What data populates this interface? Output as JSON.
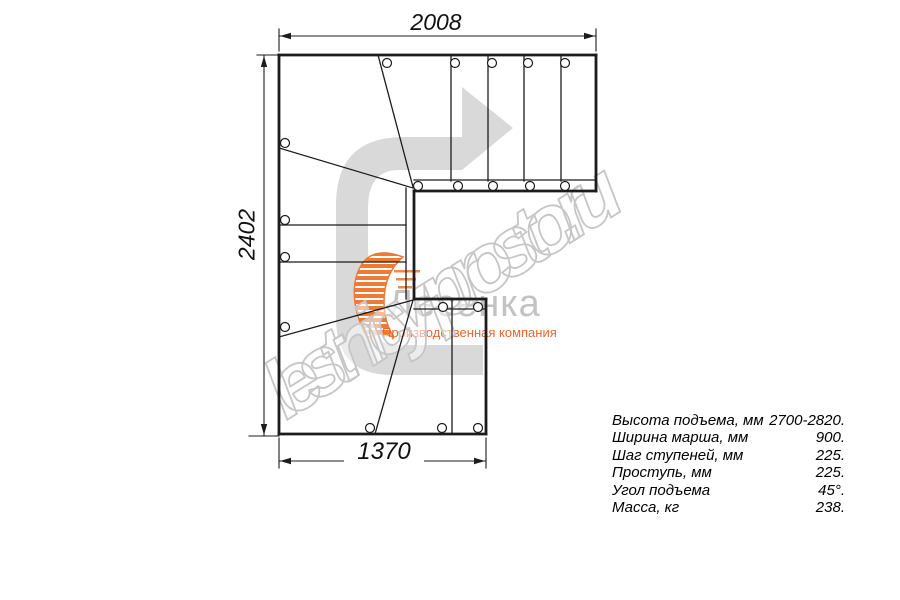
{
  "dimensions": {
    "top": "2008",
    "left": "2402",
    "bottom": "1370"
  },
  "specs": [
    {
      "label": "Высота подъема, мм",
      "value": "2700-2820."
    },
    {
      "label": "Ширина марша, мм",
      "value": "900."
    },
    {
      "label": "Шаг ступеней, мм",
      "value": "225."
    },
    {
      "label": "Проступь, мм",
      "value": "225."
    },
    {
      "label": "Угол подъема",
      "value": "45°."
    },
    {
      "label": "Масса, кг",
      "value": "238."
    }
  ],
  "watermark_text": "lestnicy-prosto.ru",
  "logo": {
    "name": "Лесенка",
    "tagline": "Производственная компания"
  },
  "colors": {
    "line": "#1c1c1c",
    "arrow": "#d9d9d9",
    "watermark_outline": "#c6c6c6",
    "logo_text": "#c3c3c3",
    "flame_orange": "#ee7a36",
    "tagline_orange": "#e9672b"
  },
  "drawing": {
    "thick_segments": [
      [
        279,
        55,
        596,
        55
      ],
      [
        596,
        55,
        596,
        191
      ],
      [
        279,
        55,
        279,
        434
      ],
      [
        279,
        434,
        486,
        434
      ],
      [
        486,
        434,
        486,
        299
      ],
      [
        486,
        299,
        414,
        299
      ],
      [
        414,
        299,
        414,
        191
      ],
      [
        414,
        191,
        596,
        191
      ]
    ],
    "thin_segments": [
      [
        451,
        55,
        451,
        181
      ],
      [
        488,
        55,
        488,
        181
      ],
      [
        524,
        55,
        524,
        181
      ],
      [
        561,
        55,
        561,
        181
      ],
      [
        414,
        180,
        596,
        180
      ],
      [
        406,
        188,
        406,
        299
      ],
      [
        414,
        309,
        486,
        309
      ],
      [
        378,
        55,
        413,
        187
      ],
      [
        279,
        148,
        413,
        188
      ],
      [
        279,
        337,
        413,
        300
      ],
      [
        375,
        434,
        413,
        300
      ],
      [
        279,
        225,
        406,
        225
      ],
      [
        279,
        262,
        406,
        262
      ],
      [
        452,
        300,
        452,
        434
      ]
    ],
    "circle_radius": 4.5,
    "circles": [
      [
        387,
        63
      ],
      [
        455,
        63
      ],
      [
        492,
        63
      ],
      [
        528,
        63
      ],
      [
        565,
        63
      ],
      [
        418,
        186
      ],
      [
        458,
        186
      ],
      [
        493,
        186
      ],
      [
        530,
        186
      ],
      [
        565,
        186
      ],
      [
        285,
        143
      ],
      [
        285,
        220
      ],
      [
        285,
        257
      ],
      [
        285,
        327
      ],
      [
        443,
        307
      ],
      [
        478,
        307
      ],
      [
        370,
        428
      ],
      [
        442,
        428
      ],
      [
        478,
        428
      ]
    ],
    "dim_lines": [
      [
        279,
        36,
        596,
        36
      ],
      [
        264,
        55,
        264,
        436
      ],
      [
        279,
        461,
        486,
        461
      ]
    ],
    "ext_lines": [
      [
        279,
        51,
        279,
        29
      ],
      [
        596,
        51,
        596,
        29
      ],
      [
        257,
        55,
        279,
        55
      ],
      [
        249,
        436,
        279,
        436
      ],
      [
        279,
        438,
        279,
        468
      ],
      [
        486,
        438,
        486,
        468
      ]
    ],
    "dim_arrows": [
      {
        "x": 280,
        "y": 36,
        "dir": "left"
      },
      {
        "x": 595,
        "y": 36,
        "dir": "right"
      },
      {
        "x": 264,
        "y": 56,
        "dir": "up"
      },
      {
        "x": 264,
        "y": 435,
        "dir": "down"
      },
      {
        "x": 280,
        "y": 461,
        "dir": "left"
      },
      {
        "x": 485,
        "y": 461,
        "dir": "right"
      }
    ],
    "direction_arrow_path": "M 483,375 L 392,375 Q 336,375 336,318 L 336,205 Q 336,137 404,137 L 462,137 L 462,87 L 513,128 L 462,170 L 399,170 Q 368,170 368,208 L 368,313 Q 368,345 400,345 L 483,345 Z"
  }
}
